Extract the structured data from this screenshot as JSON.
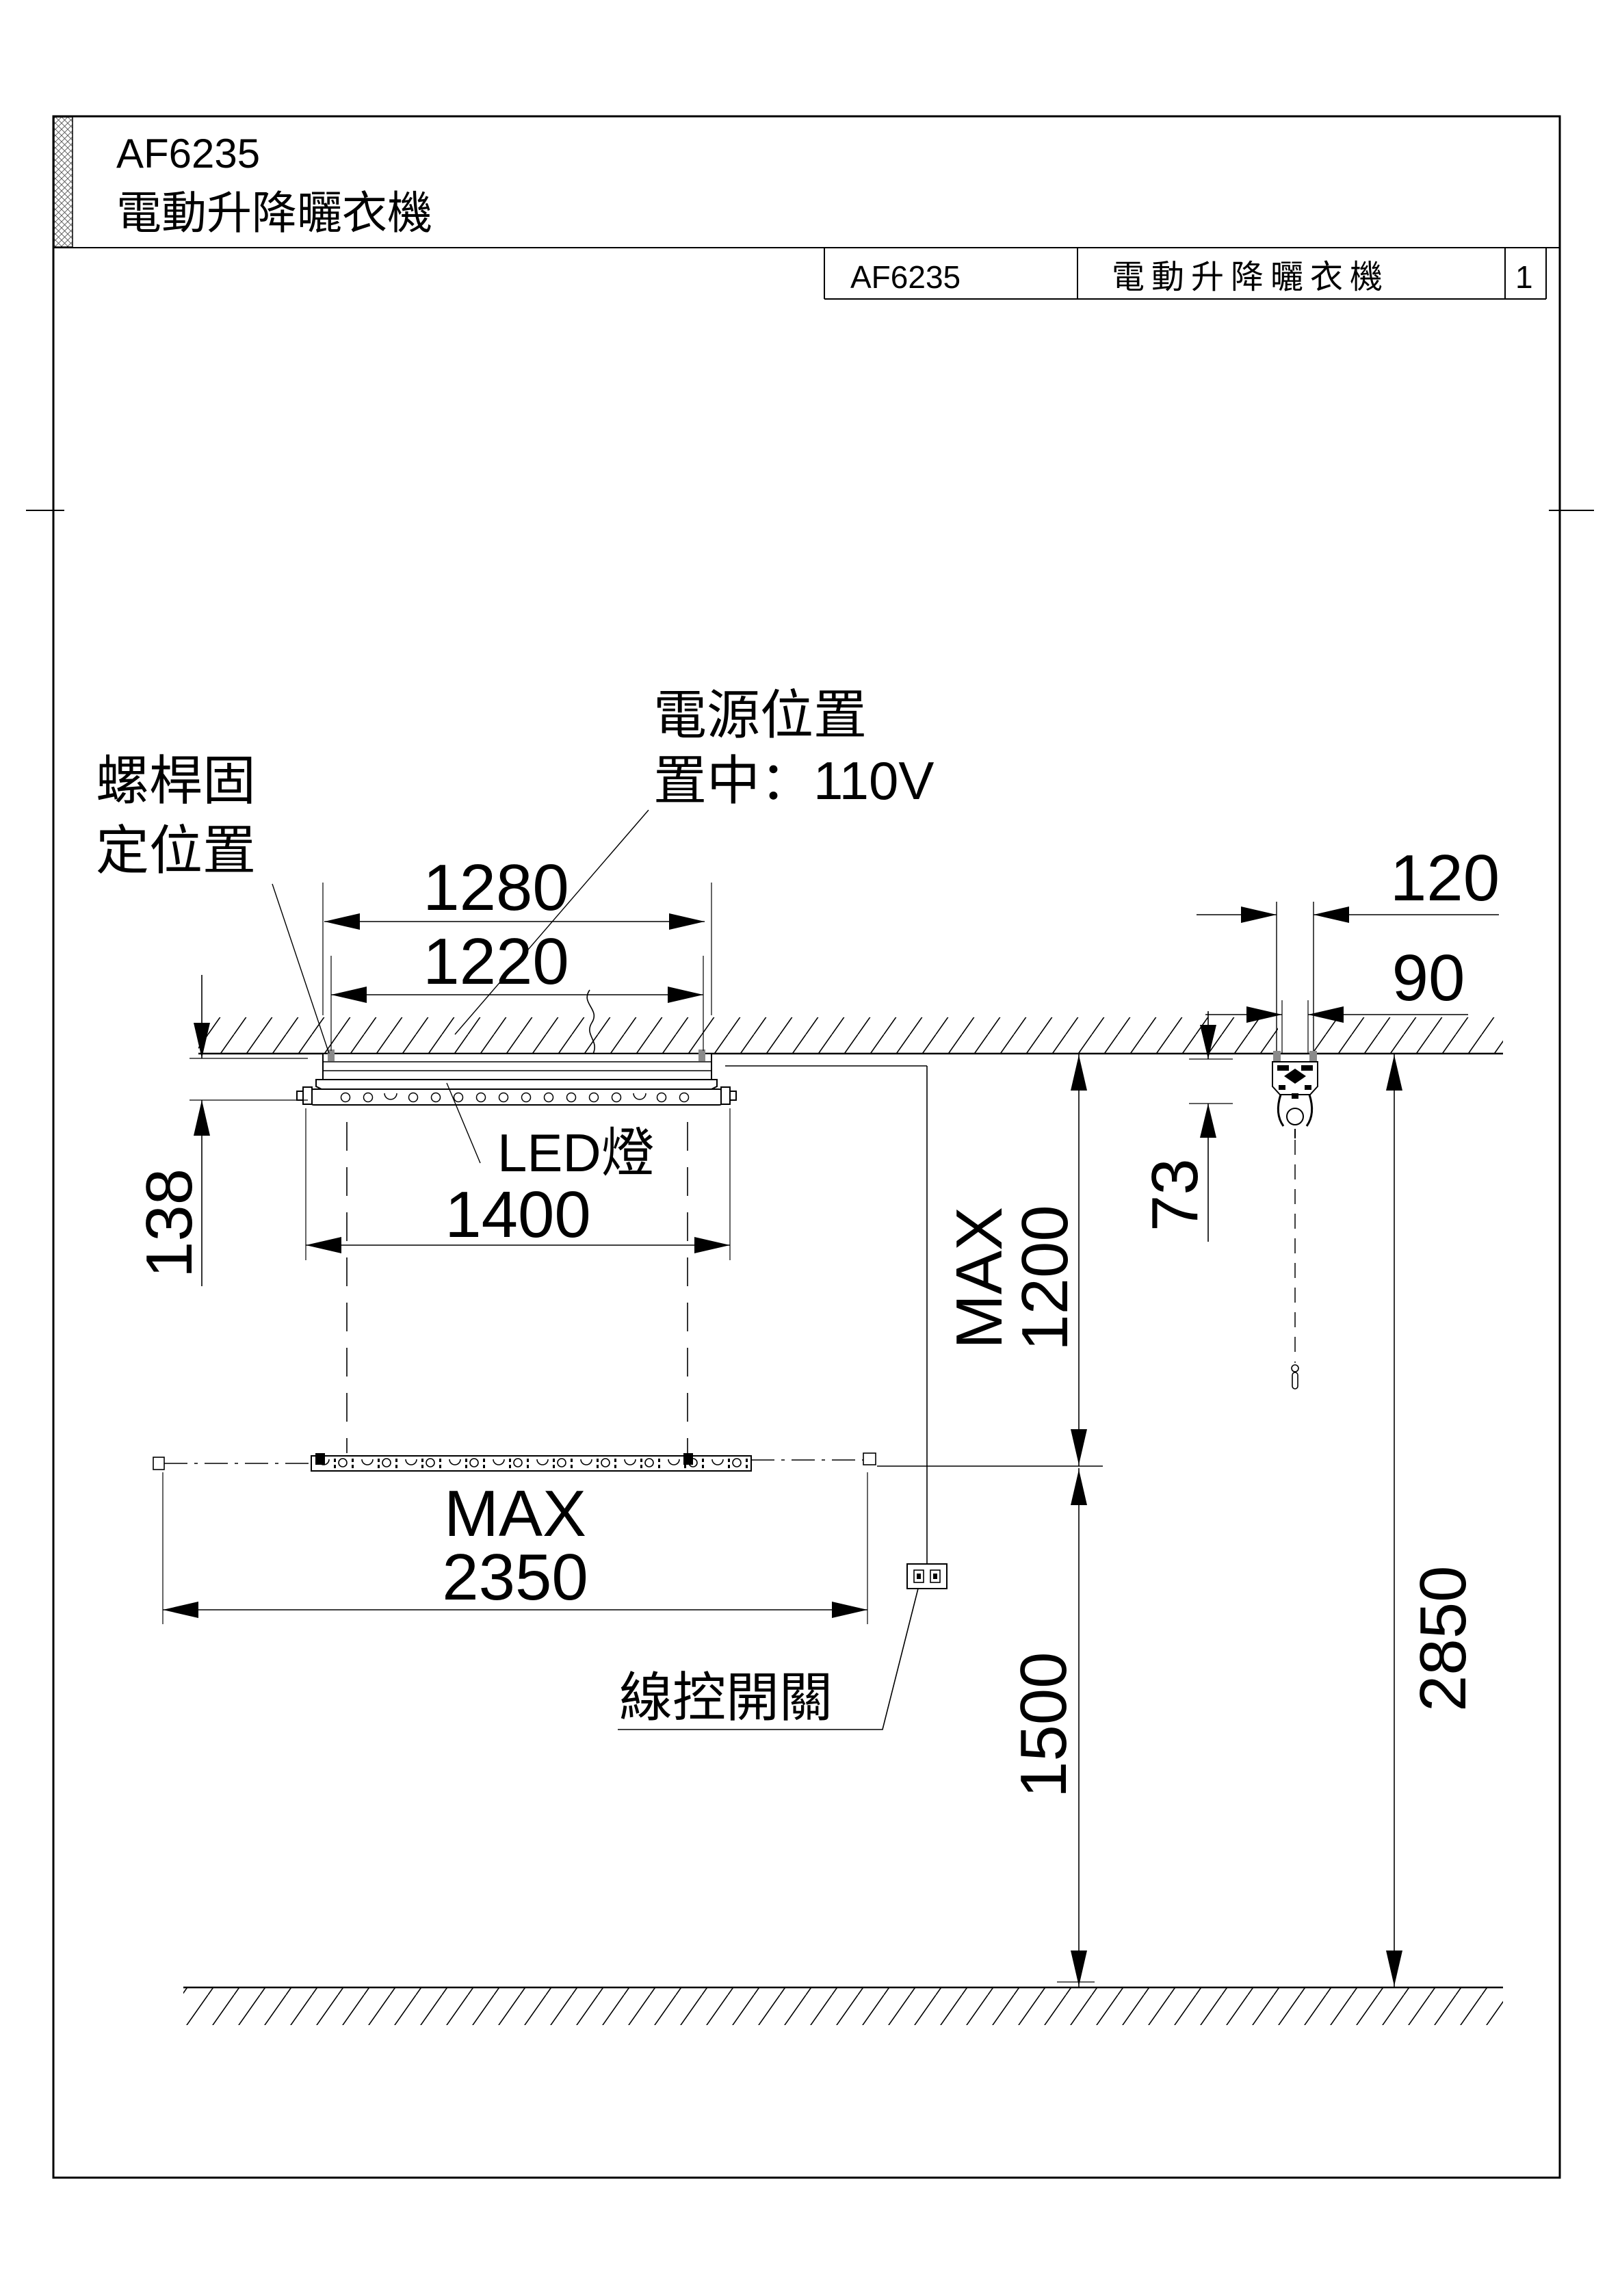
{
  "page": {
    "header": {
      "model": "AF6235",
      "product": "電動升降曬衣機"
    },
    "title_block": {
      "model": "AF6235",
      "name": "電動升降曬衣機",
      "page": "1"
    }
  },
  "drawing": {
    "labels": {
      "screw_fix_line1": "螺桿固",
      "screw_fix_line2": "定位置",
      "power_line1": "電源位置",
      "power_line2": "置中：110V",
      "led": "LED燈",
      "switch": "線控開關"
    },
    "dimensions": {
      "bracket_width": "1280",
      "screw_spacing": "1220",
      "side_offset": "120",
      "side_offset_inner": "90",
      "unit_height": "138",
      "led_width": "1400",
      "motor_height": "73",
      "drop_max_line1": "MAX",
      "drop_max_line2": "1200",
      "rack_max_line1": "MAX",
      "rack_max_line2": "2350",
      "switch_height": "1500",
      "total_height": "2850"
    },
    "colors": {
      "line": "#000000",
      "screw": "#8a8a8a"
    }
  }
}
